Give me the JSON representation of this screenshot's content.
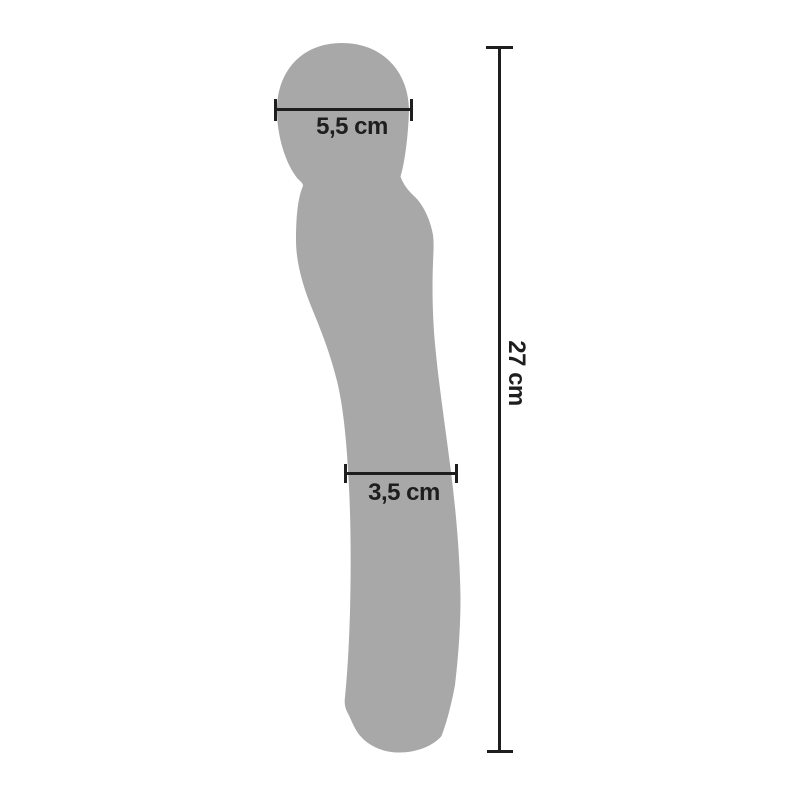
{
  "diagram": {
    "background_color": "#ffffff",
    "silhouette_color": "#a8a8a8",
    "line_color": "#1e1e1e",
    "text_color": "#1e1e1e",
    "measurements": {
      "head_width": {
        "label": "5,5 cm",
        "value": "5,5",
        "unit": "cm"
      },
      "shaft_width": {
        "label": "3,5 cm",
        "value": "3,5",
        "unit": "cm"
      },
      "total_length": {
        "label": "27 cm",
        "value": "27",
        "unit": "cm"
      }
    }
  }
}
